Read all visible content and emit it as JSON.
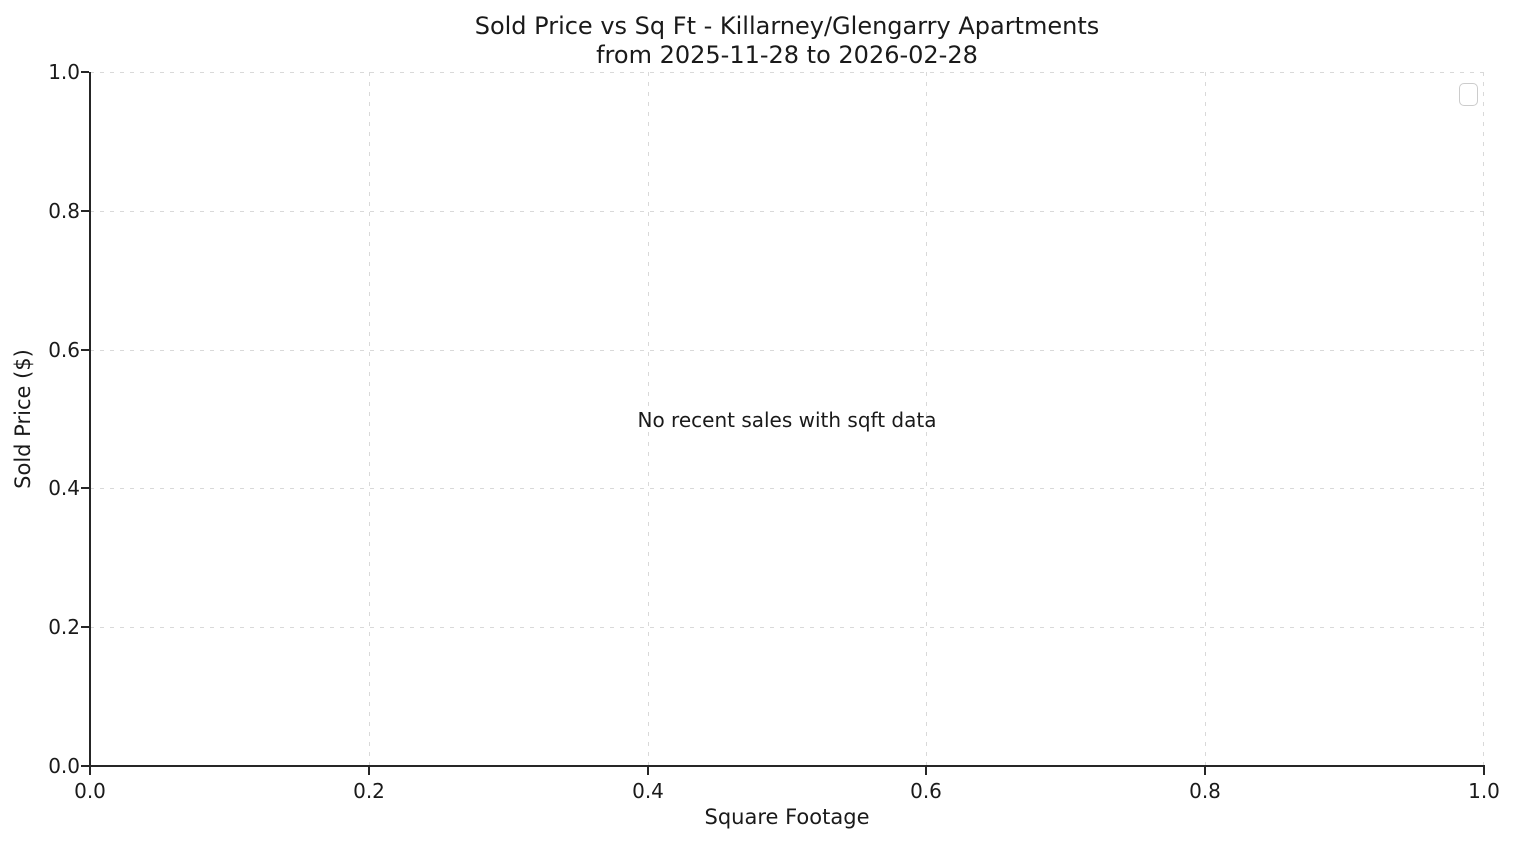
{
  "chart": {
    "title_line1": "Sold Price vs Sq Ft - Killarney/Glengarry Apartments",
    "title_line2": "from 2025-11-28 to 2026-02-28",
    "xlabel": "Square Footage",
    "ylabel": "Sold Price ($)",
    "annotation": "No recent sales with sqft data",
    "x_ticks": [
      "0.0",
      "0.2",
      "0.4",
      "0.6",
      "0.8",
      "1.0"
    ],
    "y_ticks": [
      "1.0",
      "0.8",
      "0.6",
      "0.4",
      "0.2",
      "0.0"
    ],
    "colors": {
      "background": "#ffffff",
      "text": "#1a1a1a",
      "spine": "#262626",
      "grid": "#d9d9d9",
      "legend_border": "#cccccc"
    }
  },
  "chart_data": {
    "type": "scatter",
    "title": "Sold Price vs Sq Ft - Killarney/Glengarry Apartments\nfrom 2025-11-28 to 2026-02-28",
    "xlabel": "Square Footage",
    "ylabel": "Sold Price ($)",
    "xlim": [
      0.0,
      1.0
    ],
    "ylim": [
      0.0,
      1.0
    ],
    "x_tick_labels": [
      "0.0",
      "0.2",
      "0.4",
      "0.6",
      "0.8",
      "1.0"
    ],
    "y_tick_labels": [
      "0.0",
      "0.2",
      "0.4",
      "0.6",
      "0.8",
      "1.0"
    ],
    "series": [],
    "points": [],
    "annotations": [
      "No recent sales with sqft data"
    ],
    "grid": true,
    "grid_style": "dashed",
    "legend": {
      "visible": true,
      "entries": [],
      "position": "upper right"
    }
  }
}
